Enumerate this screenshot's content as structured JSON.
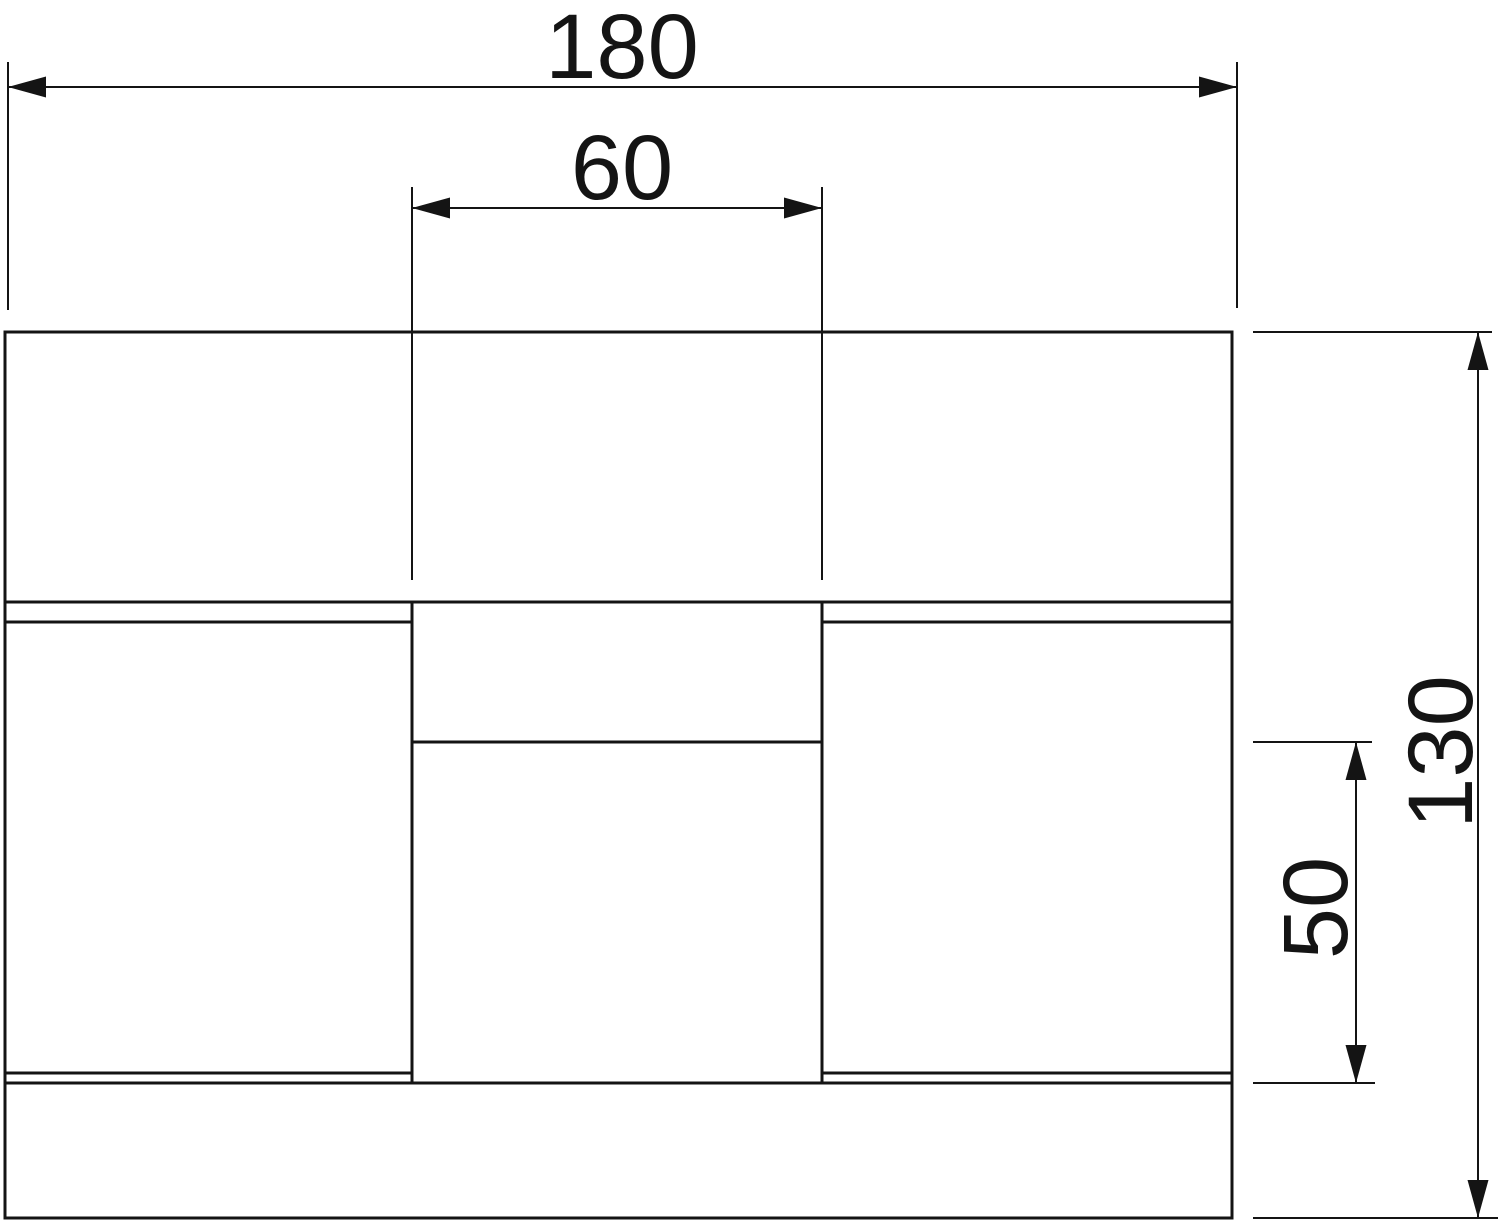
{
  "drawing": {
    "background_color": "#ffffff",
    "line_color": "#141414",
    "dimensions": {
      "total_width": {
        "label": "180"
      },
      "pocket_width": {
        "label": "60"
      },
      "total_height": {
        "label": "130"
      },
      "lower_middle_height": {
        "label": "50"
      }
    }
  }
}
